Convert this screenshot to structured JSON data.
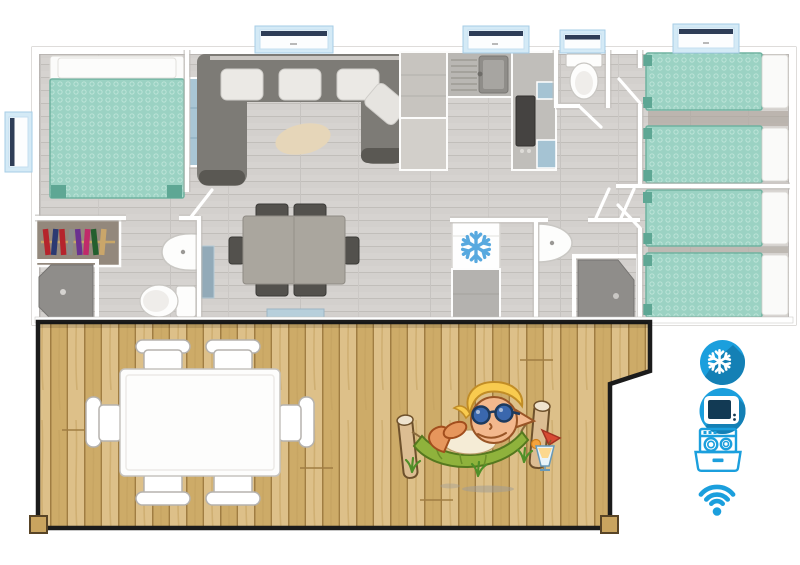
{
  "scene": {
    "type": "mobile-home floor plan top view with wooden terrace and amenity icons",
    "background": "#ffffff"
  },
  "colors": {
    "page_bg": "#ffffff",
    "accent_blue": "#1b9fdd",
    "accent_blue_dark": "#1480b5",
    "bed_teal": "#9bd2c3",
    "bed_teal_dark": "#5ea794",
    "floor_gray": "#d6d3d0",
    "sofa_gray": "#7d7b76",
    "rug_beige": "#e6d6b9",
    "deck_wood": "#d6b678",
    "deck_wood_dark": "#a07d42",
    "window_frame": "#d4eaf6",
    "window_bar": "#2e3d57",
    "wall_white": "#ffffff"
  },
  "floor_plan": {
    "rooms": [
      {
        "name": "master-bedroom",
        "furniture": [
          "double-bed",
          "bedside-cabinet"
        ]
      },
      {
        "name": "bathroom-1",
        "furniture": [
          "wardrobe",
          "corner-shower",
          "washbasin",
          "toilet"
        ]
      },
      {
        "name": "living-room",
        "furniture": [
          "u-shaped-sofa",
          "cushions",
          "oval-rug",
          "tv-cabinet"
        ]
      },
      {
        "name": "dining-area",
        "furniture": [
          "dining-table",
          "six-chairs",
          "door-mat"
        ]
      },
      {
        "name": "kitchen",
        "furniture": [
          "counter",
          "sink",
          "cooktop",
          "fridge-freezer"
        ]
      },
      {
        "name": "wc",
        "furniture": [
          "toilet"
        ]
      },
      {
        "name": "shower-room-2",
        "furniture": [
          "washbasin",
          "corner-shower"
        ]
      },
      {
        "name": "bedroom-2",
        "furniture": [
          "twin-bed",
          "twin-bed"
        ]
      },
      {
        "name": "bedroom-3",
        "furniture": [
          "twin-bed",
          "twin-bed"
        ]
      }
    ],
    "window_count": 5
  },
  "terrace": {
    "name": "wooden-deck",
    "furniture": [
      "outdoor-table",
      "six-outdoor-chairs"
    ],
    "illustration": "elf mascot relaxing in a hammock with cocktail"
  },
  "amenities": [
    {
      "icon": "air-conditioning-icon",
      "style": "filled-circle"
    },
    {
      "icon": "tv-icon",
      "style": "filled-circle"
    },
    {
      "icon": "dishwasher-icon",
      "style": "outline"
    },
    {
      "icon": "wifi-icon",
      "style": "outline"
    }
  ]
}
